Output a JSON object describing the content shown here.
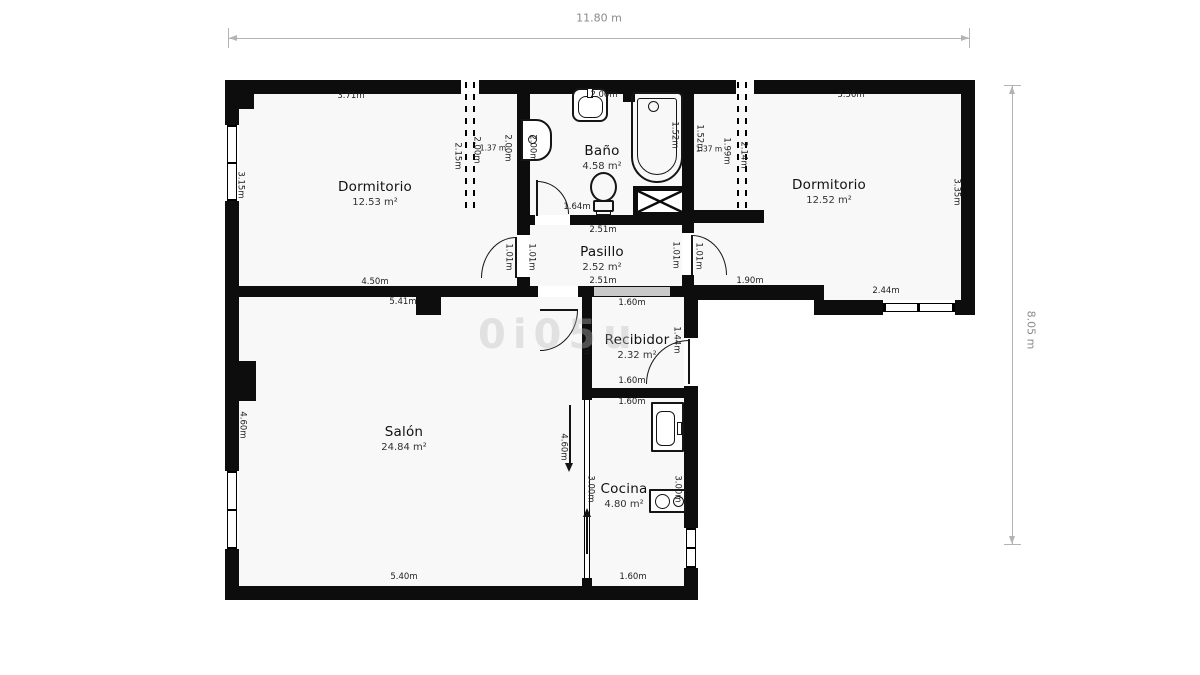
{
  "plan": {
    "total_width_label": "11.80 m",
    "total_height_label": "8.05 m",
    "watermark": "0i05u",
    "colors": {
      "wall": "#0d0d0d",
      "floor": "#f8f8f8",
      "guide": "#b3b3b3",
      "passage_bar": "#c9c9c9"
    }
  },
  "rooms": [
    {
      "name": "Dormitorio",
      "area": "12.53 m²",
      "x": 375,
      "y": 194
    },
    {
      "name": "Baño",
      "area": "4.58 m²",
      "x": 602,
      "y": 158
    },
    {
      "name": "Dormitorio",
      "area": "12.52 m²",
      "x": 829,
      "y": 192
    },
    {
      "name": "Pasillo",
      "area": "2.52 m²",
      "x": 602,
      "y": 259
    },
    {
      "name": "Recibidor",
      "area": "2.32 m²",
      "x": 637,
      "y": 347
    },
    {
      "name": "Salón",
      "area": "24.84 m²",
      "x": 404,
      "y": 439
    },
    {
      "name": "Cocina",
      "area": "4.80 m²",
      "x": 624,
      "y": 496
    }
  ],
  "dim_labels": [
    {
      "text": "11.80 m",
      "x": 599,
      "y": 18,
      "rot": "h",
      "muted": true
    },
    {
      "text": "8.05 m",
      "x": 1031,
      "y": 330,
      "rot": "v",
      "muted": true
    },
    {
      "text": "3.71m",
      "x": 351,
      "y": 96,
      "rot": "h"
    },
    {
      "text": "3.15m",
      "x": 240,
      "y": 185,
      "rot": "v"
    },
    {
      "text": "4.50m",
      "x": 375,
      "y": 282,
      "rot": "h"
    },
    {
      "text": "2.15m",
      "x": 457,
      "y": 156,
      "rot": "v"
    },
    {
      "text": "2.00m",
      "x": 476,
      "y": 150,
      "rot": "v"
    },
    {
      "text": "1.37 m",
      "x": 493,
      "y": 148,
      "rot": "h",
      "size": 7.5
    },
    {
      "text": "2.00m",
      "x": 507,
      "y": 148,
      "rot": "v"
    },
    {
      "text": "2.00m",
      "x": 604,
      "y": 95,
      "rot": "h",
      "under": true
    },
    {
      "text": "2.00m",
      "x": 532,
      "y": 148,
      "rot": "v"
    },
    {
      "text": "1.64m",
      "x": 577,
      "y": 207,
      "rot": "h"
    },
    {
      "text": "1.52m",
      "x": 674,
      "y": 135,
      "rot": "v"
    },
    {
      "text": "1.52m",
      "x": 699,
      "y": 138,
      "rot": "v"
    },
    {
      "text": "1.37 m",
      "x": 709,
      "y": 149,
      "rot": "h",
      "size": 7.5
    },
    {
      "text": "1.99m",
      "x": 726,
      "y": 151,
      "rot": "v"
    },
    {
      "text": "2.14m",
      "x": 743,
      "y": 155,
      "rot": "v"
    },
    {
      "text": "3.56m",
      "x": 851,
      "y": 95,
      "rot": "h"
    },
    {
      "text": "3.35m",
      "x": 956,
      "y": 192,
      "rot": "v"
    },
    {
      "text": "1.90m",
      "x": 750,
      "y": 281,
      "rot": "h"
    },
    {
      "text": "2.44m",
      "x": 886,
      "y": 291,
      "rot": "h"
    },
    {
      "text": "1.01m",
      "x": 508,
      "y": 257,
      "rot": "v"
    },
    {
      "text": "1.01m",
      "x": 531,
      "y": 257,
      "rot": "v"
    },
    {
      "text": "1.01m",
      "x": 675,
      "y": 255,
      "rot": "v"
    },
    {
      "text": "1.01m",
      "x": 698,
      "y": 256,
      "rot": "v"
    },
    {
      "text": "2.51m",
      "x": 603,
      "y": 230,
      "rot": "h"
    },
    {
      "text": "2.51m",
      "x": 603,
      "y": 281,
      "rot": "h"
    },
    {
      "text": "1.60m",
      "x": 632,
      "y": 303,
      "rot": "h"
    },
    {
      "text": "1.60m",
      "x": 632,
      "y": 381,
      "rot": "h"
    },
    {
      "text": "1.45m",
      "x": 586,
      "y": 341,
      "rot": "v"
    },
    {
      "text": "1.44m",
      "x": 676,
      "y": 340,
      "rot": "v"
    },
    {
      "text": "5.41m",
      "x": 403,
      "y": 302,
      "rot": "h"
    },
    {
      "text": "4.60m",
      "x": 242,
      "y": 425,
      "rot": "v"
    },
    {
      "text": "5.40m",
      "x": 404,
      "y": 577,
      "rot": "h"
    },
    {
      "text": "4.60m",
      "x": 563,
      "y": 447,
      "rot": "v"
    },
    {
      "text": "3.00m",
      "x": 590,
      "y": 489,
      "rot": "v"
    },
    {
      "text": "3.00m",
      "x": 677,
      "y": 489,
      "rot": "v"
    },
    {
      "text": "1.60m",
      "x": 632,
      "y": 402,
      "rot": "h"
    },
    {
      "text": "1.60m",
      "x": 633,
      "y": 577,
      "rot": "h"
    }
  ]
}
